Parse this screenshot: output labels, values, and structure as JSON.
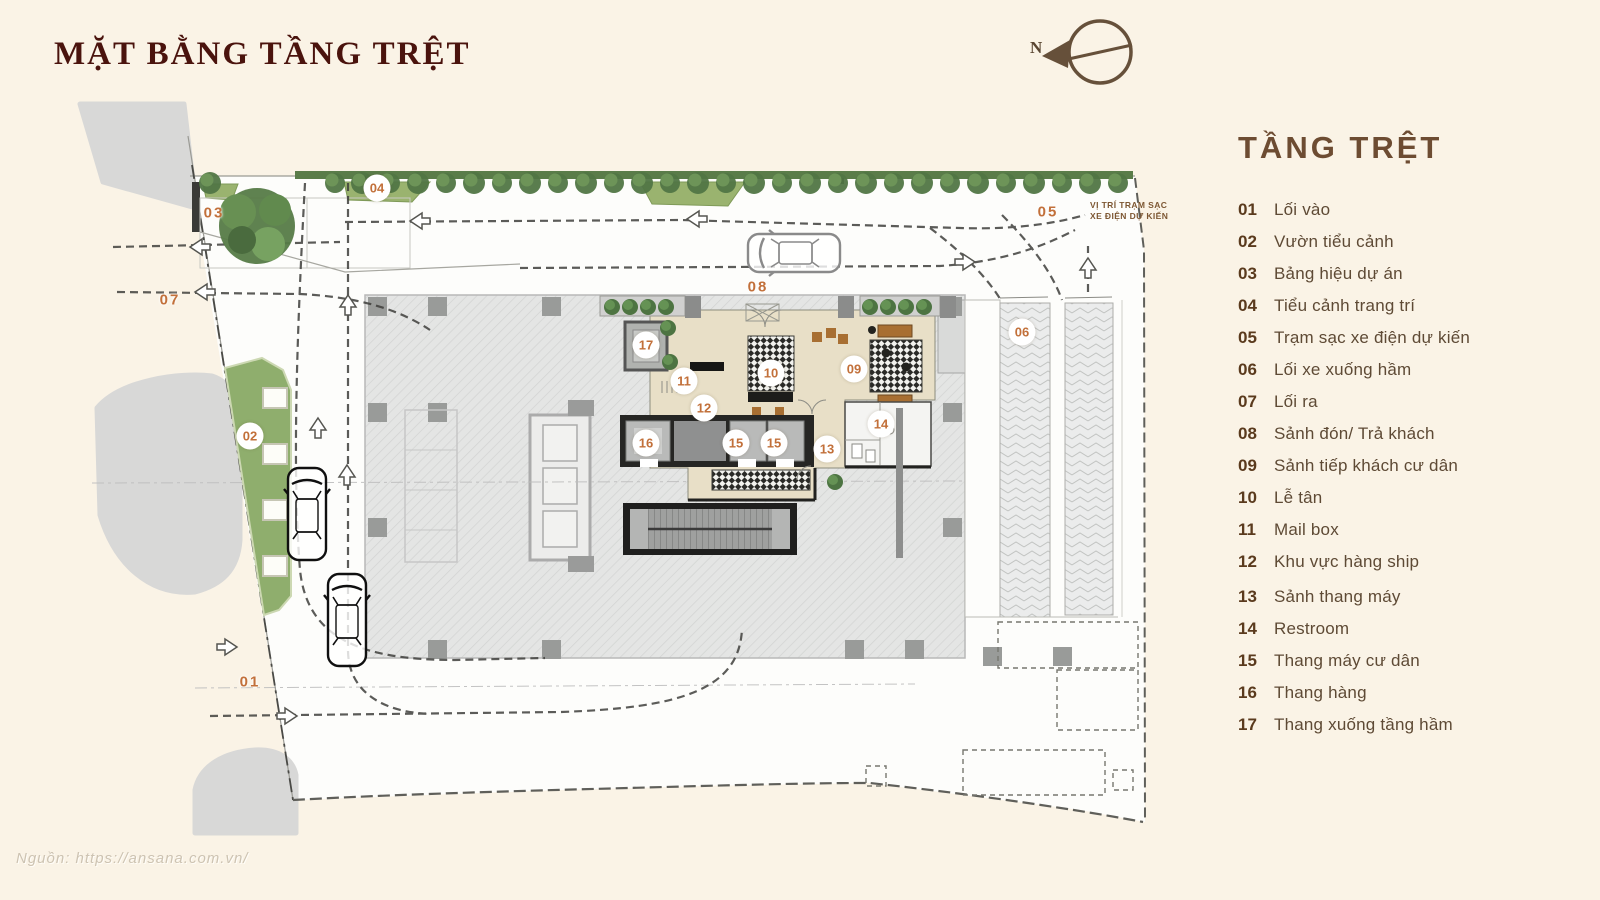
{
  "title": "MẶT BẰNG TẦNG TRỆT",
  "compass": {
    "north": "N"
  },
  "legend": {
    "heading": "TẦNG TRỆT",
    "groups": [
      [
        {
          "num": "01",
          "label": "Lối vào"
        },
        {
          "num": "02",
          "label": "Vườn tiểu cảnh"
        },
        {
          "num": "03",
          "label": "Bảng hiệu dự án"
        },
        {
          "num": "04",
          "label": "Tiểu cảnh trang trí"
        },
        {
          "num": "05",
          "label": "Trạm sạc xe điện dự kiến"
        },
        {
          "num": "06",
          "label": "Lối xe xuống hầm"
        }
      ],
      [
        {
          "num": "07",
          "label": "Lối ra"
        },
        {
          "num": "08",
          "label": "Sảnh đón/ Trả khách"
        },
        {
          "num": "09",
          "label": "Sảnh tiếp khách cư dân"
        },
        {
          "num": "10",
          "label": "Lễ tân"
        },
        {
          "num": "11",
          "label": "Mail box"
        },
        {
          "num": "12",
          "label": "Khu vực hàng ship"
        }
      ],
      [
        {
          "num": "13",
          "label": "Sảnh thang máy"
        },
        {
          "num": "14",
          "label": "Restroom"
        },
        {
          "num": "15",
          "label": "Thang máy cư dân"
        },
        {
          "num": "16",
          "label": "Thang hàng"
        },
        {
          "num": "17",
          "label": "Thang xuống tầng hầm"
        }
      ]
    ]
  },
  "plan_markers": [
    {
      "num": "01",
      "x": 250,
      "y": 682,
      "style": "text"
    },
    {
      "num": "02",
      "x": 250,
      "y": 436,
      "style": "circle"
    },
    {
      "num": "03",
      "x": 214,
      "y": 213,
      "style": "text"
    },
    {
      "num": "04",
      "x": 377,
      "y": 188,
      "style": "circle"
    },
    {
      "num": "05",
      "x": 1048,
      "y": 212,
      "style": "text"
    },
    {
      "num": "06",
      "x": 1022,
      "y": 332,
      "style": "circle"
    },
    {
      "num": "07",
      "x": 170,
      "y": 300,
      "style": "text"
    },
    {
      "num": "08",
      "x": 758,
      "y": 287,
      "style": "text"
    },
    {
      "num": "09",
      "x": 854,
      "y": 369,
      "style": "circle"
    },
    {
      "num": "10",
      "x": 771,
      "y": 373,
      "style": "circle"
    },
    {
      "num": "11",
      "x": 684,
      "y": 381,
      "style": "circle"
    },
    {
      "num": "12",
      "x": 704,
      "y": 408,
      "style": "circle"
    },
    {
      "num": "13",
      "x": 827,
      "y": 449,
      "style": "circle"
    },
    {
      "num": "14",
      "x": 881,
      "y": 424,
      "style": "circle"
    },
    {
      "num": "15",
      "x": 736,
      "y": 443,
      "style": "circle"
    },
    {
      "num": "15",
      "x": 774,
      "y": 443,
      "style": "circle",
      "key": "15b"
    },
    {
      "num": "16",
      "x": 646,
      "y": 443,
      "style": "circle"
    },
    {
      "num": "17",
      "x": 646,
      "y": 345,
      "style": "circle"
    }
  ],
  "plan_note": {
    "x": 1090,
    "y": 200,
    "lines": [
      "VỊ TRÍ TRẠM SẠC",
      "XE ĐIỆN DỰ KIẾN"
    ]
  },
  "source": "Nguồn: https://ansana.com.vn/",
  "colors": {
    "background": "#faf3e6",
    "title": "#4a130d",
    "legend_heading": "#6d4c32",
    "legend_text": "#5e4a35",
    "marker_orange": "#c2703a",
    "garden_green": "#8fae6d",
    "tree_green": "#4f7343",
    "lobby_beige": "#e8dfc7",
    "slab_gray": "#e4e5e4"
  }
}
